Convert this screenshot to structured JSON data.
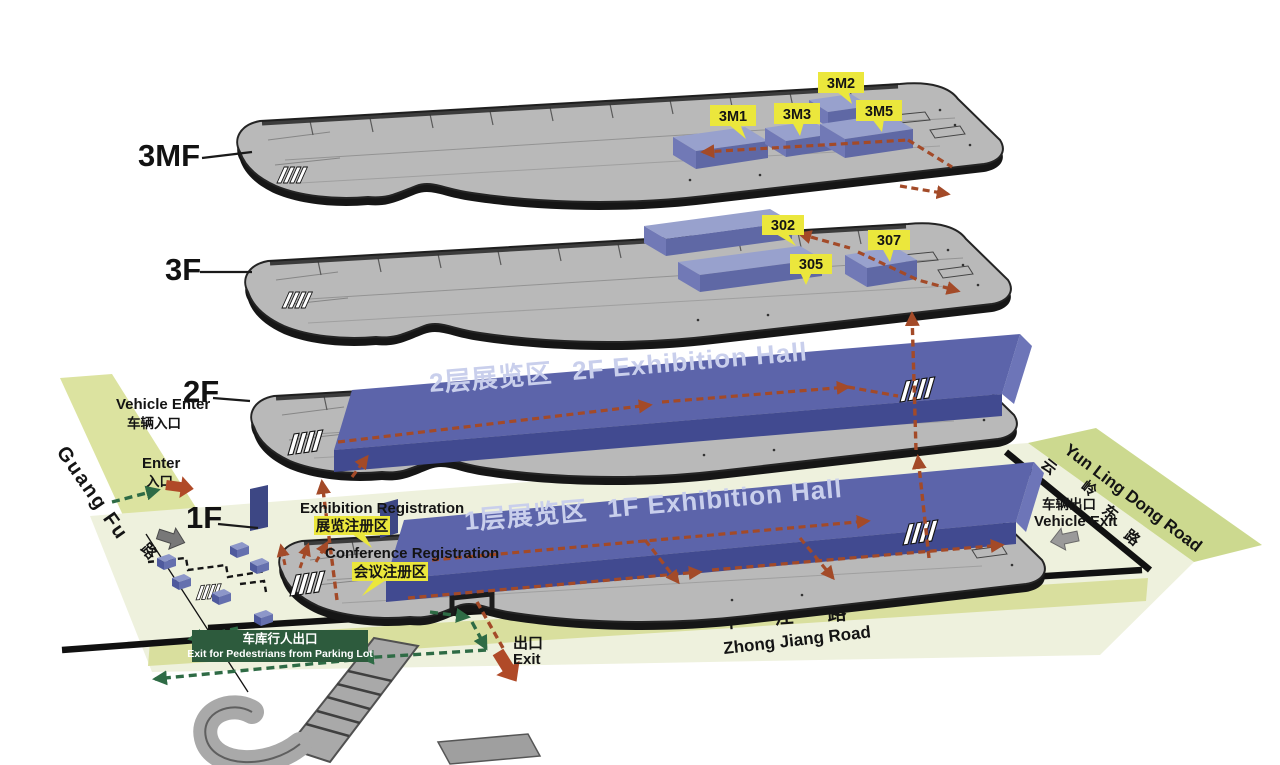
{
  "floors": [
    {
      "label": "3MF"
    },
    {
      "label": "3F"
    },
    {
      "label": "2F"
    },
    {
      "label": "1F"
    }
  ],
  "rooms": {
    "floor_3mf": [
      "3M1",
      "3M2",
      "3M3",
      "3M5"
    ],
    "floor_3f": [
      "302",
      "305",
      "307"
    ]
  },
  "halls": {
    "f2": {
      "cn": "2层展览区",
      "en": "2F Exhibition Hall"
    },
    "f1": {
      "cn": "1层展览区",
      "en": "1F Exhibition Hall"
    }
  },
  "labels": {
    "vehicle_enter_en": "Vehicle Enter",
    "vehicle_enter_cn": "车辆入口",
    "enter_en": "Enter",
    "enter_cn": "入口",
    "exhibition_reg_en": "Exhibition Registration",
    "exhibition_reg_cn": "展览注册区",
    "conference_reg_en": "Conference Registration",
    "conference_reg_cn": "会议注册区",
    "pedestrian_exit_cn": "车库行人出口",
    "pedestrian_exit_en": "Exit for Pedestrians from Parking Lot",
    "exit_cn": "出口",
    "exit_en": "Exit",
    "vehicle_exit_cn": "车辆出口",
    "vehicle_exit_en": "Vehicle Exit"
  },
  "roads": {
    "guangfu_en": "Guang Fu",
    "guangfu_cn": "路",
    "zhongjiang_cn": "中江路",
    "zhongjiang_en": "Zhong Jiang Road",
    "yunling_en": "Yun Ling Dong Road",
    "yunling_cn": [
      "云",
      "岭",
      "东",
      "路"
    ]
  },
  "colors": {
    "room_label_bg": "#ebe73c",
    "hall_blue_top": "#5c64aa",
    "hall_blue_front": "#414a90",
    "plate_gray": "#b9b9b9",
    "path_red": "#a34a28",
    "route_green": "#2e6b45",
    "exit_box_green": "#2d5b3d",
    "ground": "#eef1dd",
    "road": "#d9df9e"
  }
}
